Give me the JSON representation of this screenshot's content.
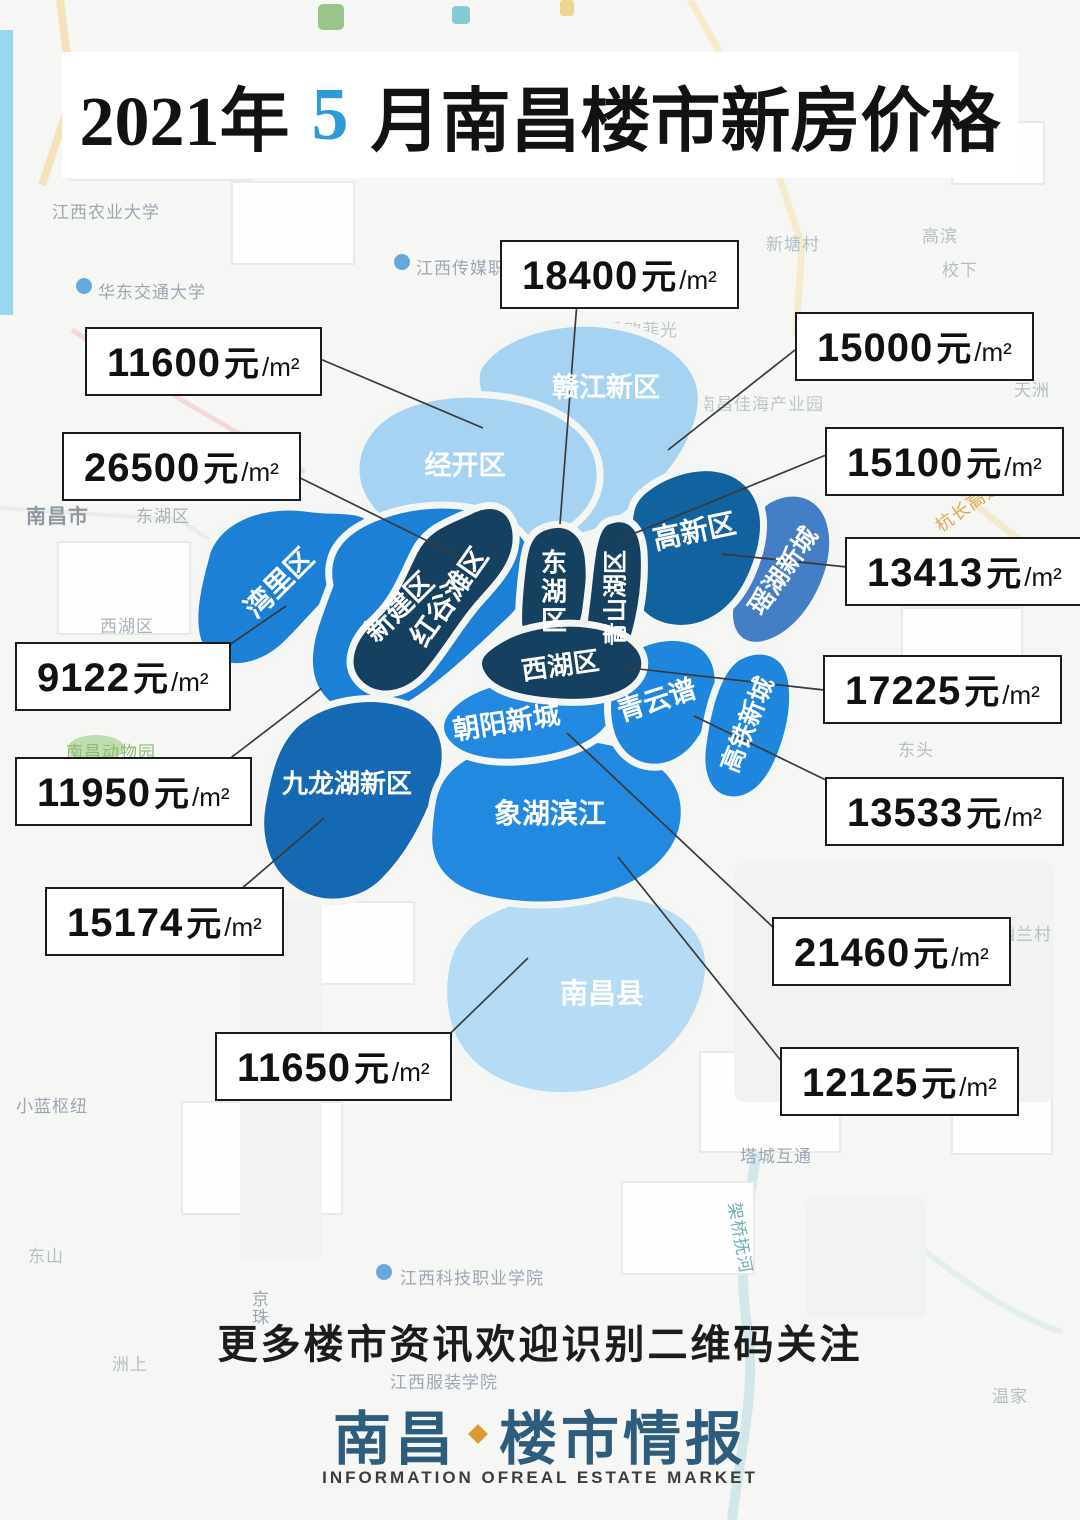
{
  "title": {
    "prefix": "2021年",
    "month": "5",
    "suffix": "月南昌楼市新房价格",
    "month_accent_color": "#2d9bd8"
  },
  "regions": [
    {
      "name": "赣江新区",
      "color": "#a7d3f2"
    },
    {
      "name": "经开区",
      "color": "#a7d3f2"
    },
    {
      "name": "湾里区",
      "color": "#1c80d6"
    },
    {
      "name": "新建区",
      "color": "#1c80d6"
    },
    {
      "name": "红谷滩区",
      "color": "#16405f"
    },
    {
      "name": "东湖区",
      "color": "#16405f"
    },
    {
      "name": "青山湖区",
      "color": "#16405f"
    },
    {
      "name": "西湖区",
      "color": "#16405f"
    },
    {
      "name": "高新区",
      "color": "#11629f"
    },
    {
      "name": "瑶湖新城",
      "color": "#447fc6"
    },
    {
      "name": "青云谱",
      "color": "#1e86dc"
    },
    {
      "name": "高铁新城",
      "color": "#1e86dc"
    },
    {
      "name": "朝阳新城",
      "color": "#2289e0"
    },
    {
      "name": "象湖滨江",
      "color": "#2289e0"
    },
    {
      "name": "九龙湖新区",
      "color": "#1569b2"
    },
    {
      "name": "南昌县",
      "color": "#b5dbf5"
    }
  ],
  "price_labels": [
    {
      "value": "18400",
      "unit": "元",
      "per": "/m²",
      "region": "东湖区"
    },
    {
      "value": "15000",
      "unit": "元",
      "per": "/m²",
      "region": "赣江新区"
    },
    {
      "value": "11600",
      "unit": "元",
      "per": "/m²",
      "region": "经开区"
    },
    {
      "value": "26500",
      "unit": "元",
      "per": "/m²",
      "region": "红谷滩区"
    },
    {
      "value": "15100",
      "unit": "元",
      "per": "/m²",
      "region": "青山湖区"
    },
    {
      "value": "13413",
      "unit": "元",
      "per": "/m²",
      "region": "高新区"
    },
    {
      "value": "9122",
      "unit": "元",
      "per": "/m²",
      "region": "湾里区"
    },
    {
      "value": "17225",
      "unit": "元",
      "per": "/m²",
      "region": "西湖区"
    },
    {
      "value": "11950",
      "unit": "元",
      "per": "/m²",
      "region": "新建区"
    },
    {
      "value": "13533",
      "unit": "元",
      "per": "/m²",
      "region": "青云谱"
    },
    {
      "value": "15174",
      "unit": "元",
      "per": "/m²",
      "region": "九龙湖新区"
    },
    {
      "value": "21460",
      "unit": "元",
      "per": "/m²",
      "region": "朝阳新城"
    },
    {
      "value": "11650",
      "unit": "元",
      "per": "/m²",
      "region": "南昌县"
    },
    {
      "value": "12125",
      "unit": "元",
      "per": "/m²",
      "region": "象湖滨江"
    }
  ],
  "footer": {
    "cta": "更多楼市资讯欢迎识别二维码关注",
    "logo_left": "南昌",
    "logo_right": "楼市情报",
    "logo_color": "#2d5c7d",
    "logo_en": "INFORMATION OFREAL ESTATE MARKET"
  },
  "map_background": {
    "labels": [
      {
        "text": "江西农业大学"
      },
      {
        "text": "华东交通大学"
      },
      {
        "text": "江西传媒职业学院"
      },
      {
        "text": "南昌欧菲光"
      },
      {
        "text": "新塘村"
      },
      {
        "text": "高滨"
      },
      {
        "text": "校下"
      },
      {
        "text": "南昌佳海产业园"
      },
      {
        "text": "天洲"
      },
      {
        "text": "南昌市"
      },
      {
        "text": "东湖区"
      },
      {
        "text": "西湖区"
      },
      {
        "text": "杭长高速"
      },
      {
        "text": "南昌动物园"
      },
      {
        "text": "下村"
      },
      {
        "text": "东头"
      },
      {
        "text": "幽兰村"
      },
      {
        "text": "小蓝枢纽"
      },
      {
        "text": "塔城互通"
      },
      {
        "text": "江西科技职业学院"
      },
      {
        "text": "江西服装学院"
      },
      {
        "text": "架桥抚河"
      },
      {
        "text": "东山"
      },
      {
        "text": "洲上"
      },
      {
        "text": "温家"
      },
      {
        "text": "京珠"
      }
    ]
  }
}
